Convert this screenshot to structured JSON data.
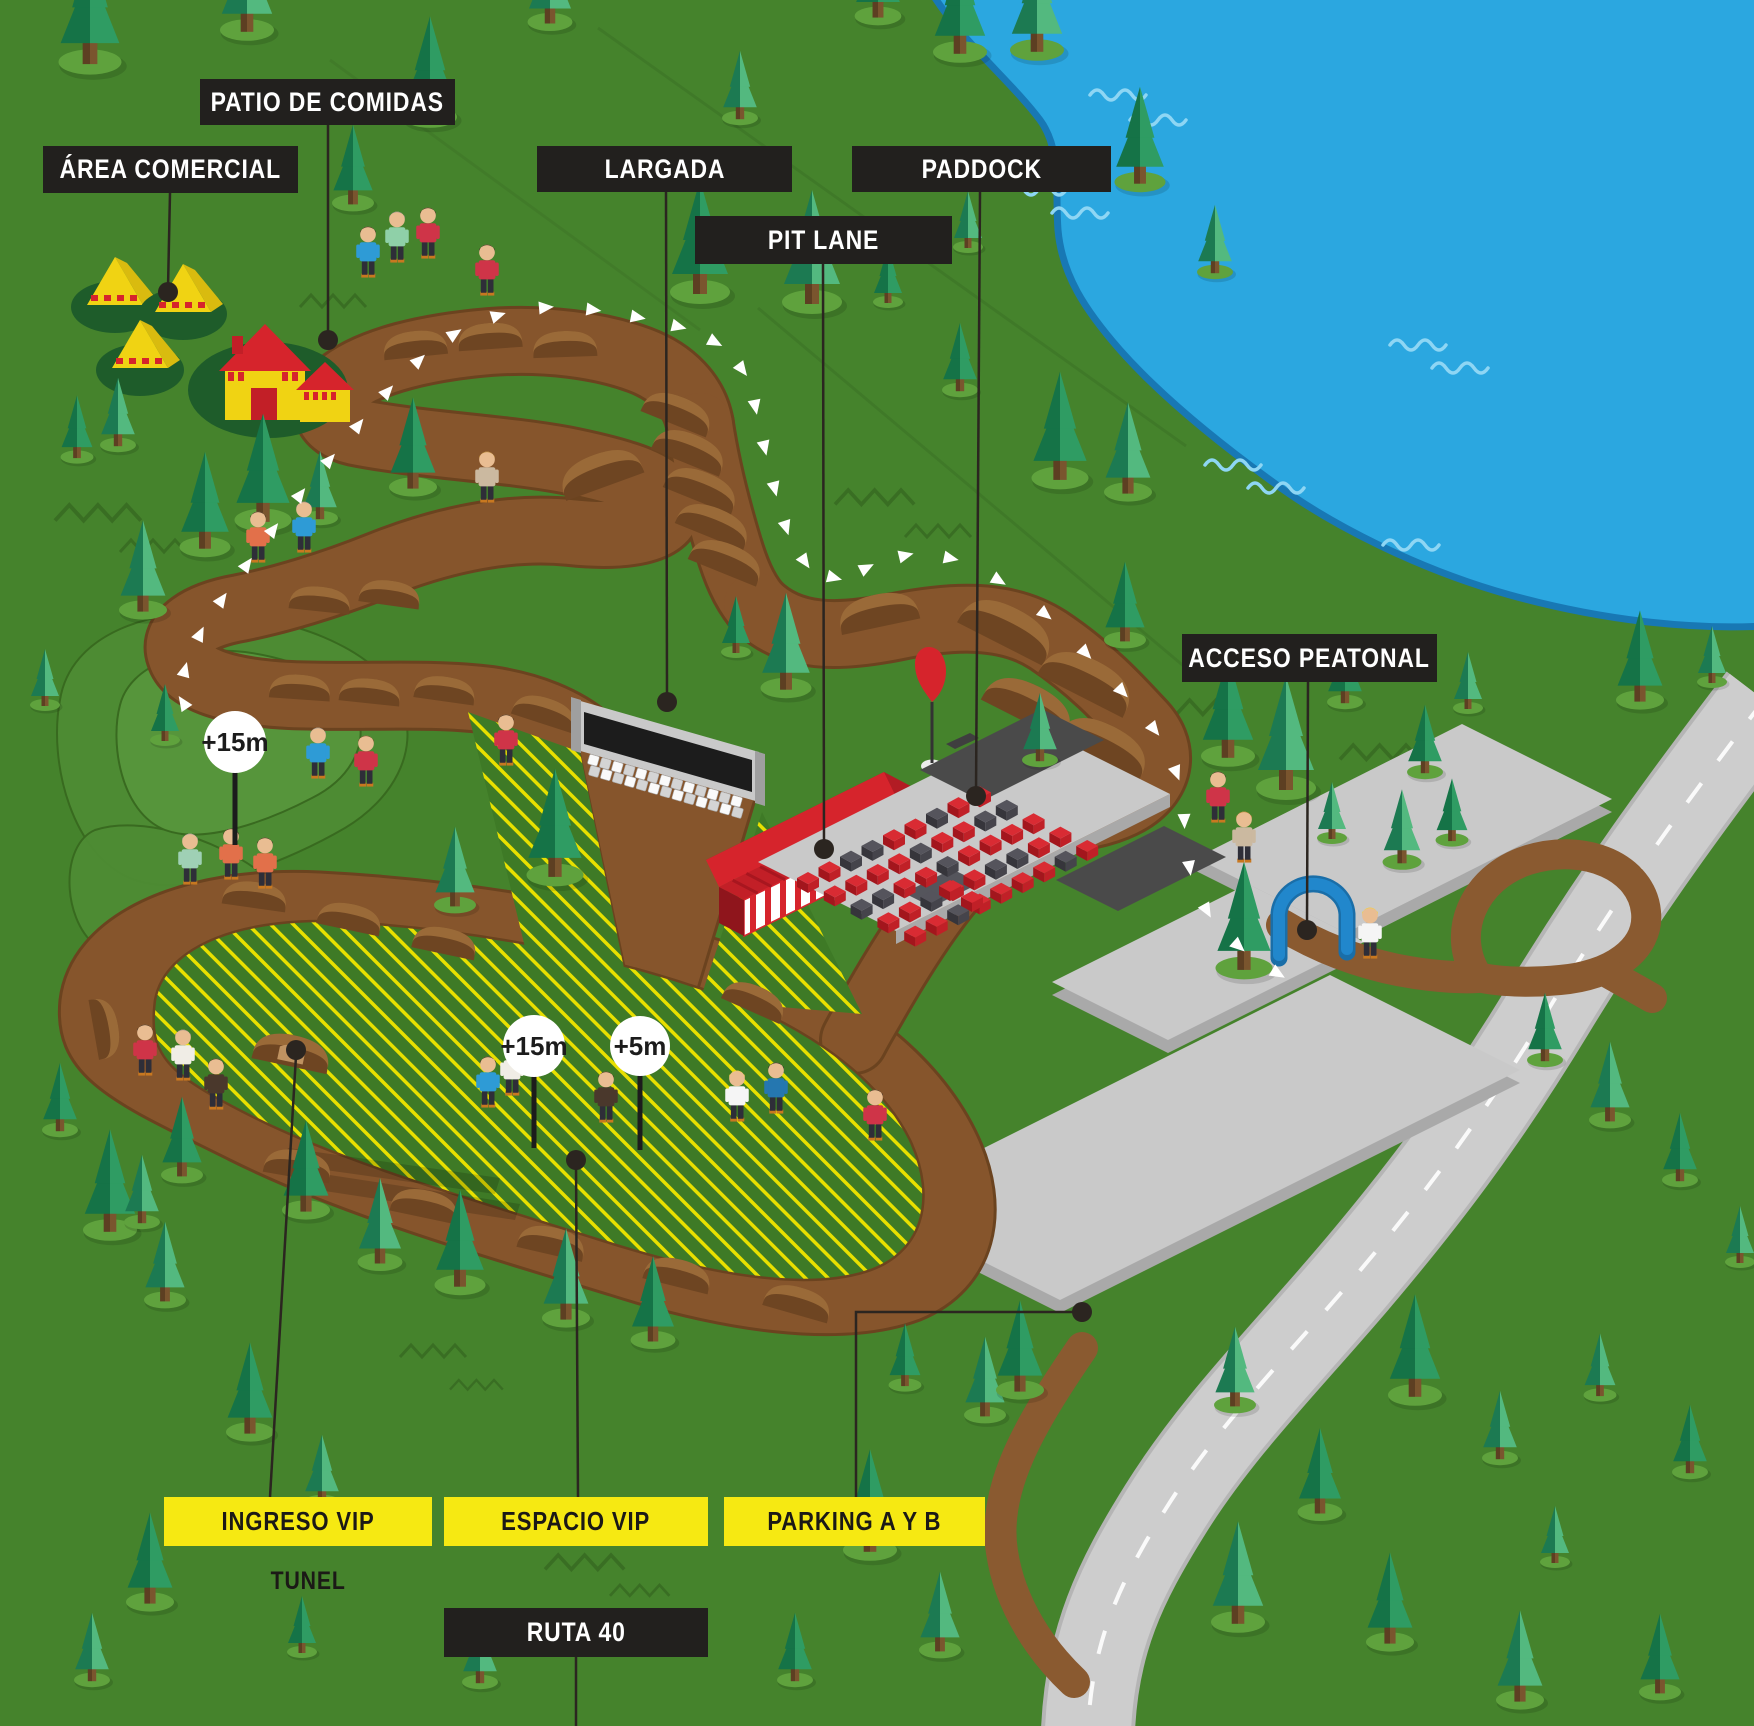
{
  "map_labels": {
    "patio_de_comidas": "PATIO DE COMIDAS",
    "area_comercial": "ÁREA COMERCIAL",
    "largada": "LARGADA",
    "pit_lane": "PIT LANE",
    "paddock": "PADDOCK",
    "acceso_peatonal": "ACCESO PEATONAL",
    "ingreso_vip": "INGRESO VIP",
    "espacio_vip": "ESPACIO VIP",
    "parking_a_y_b": "PARKING A Y B",
    "tunel": "TUNEL",
    "ruta_40": "RUTA 40"
  },
  "markers": {
    "hill": {
      "value": "+15m"
    },
    "infield": {
      "value": "+15m"
    },
    "start": {
      "value": "+5m"
    }
  },
  "colors": {
    "grass": "#45832c",
    "lake": "#2ba7e0",
    "lake_edge": "#1878b4",
    "track": "#86552c",
    "track_edge": "#6b431f",
    "label_dark": "#22201e",
    "label_yellow": "#f6e912",
    "hatch_yellow": "#e8e000",
    "pit_red": "#d6242c",
    "arch_blue": "#2187cc",
    "road_gray": "#cdcdcd"
  }
}
